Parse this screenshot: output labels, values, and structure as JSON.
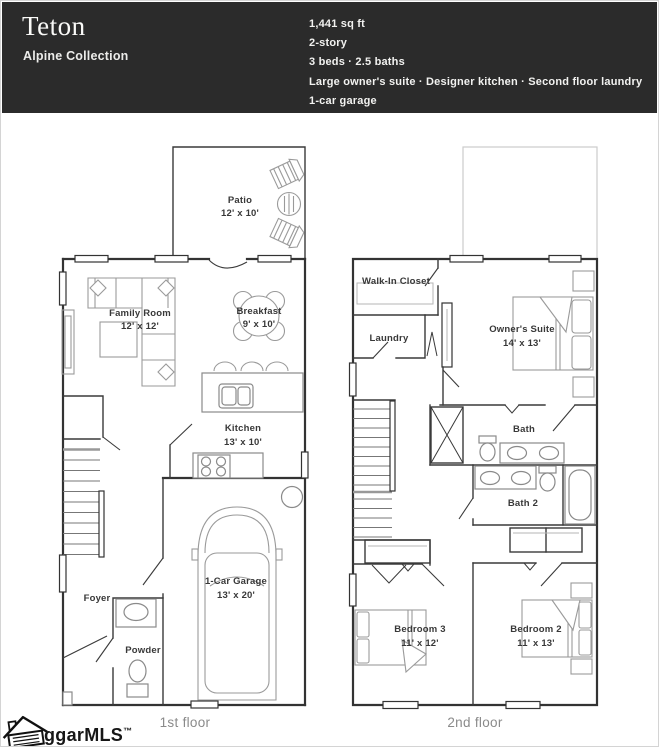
{
  "header": {
    "title": "Teton",
    "collection": "Alpine Collection",
    "specs": [
      "1,441 sq ft",
      "2-story",
      "3 beds · 2.5 baths",
      "Large owner's suite · Designer kitchen · Second floor laundry",
      "1-car garage"
    ]
  },
  "floor1": {
    "caption": "1st floor",
    "rooms": {
      "patio": {
        "name": "Patio",
        "dims": "12' x 10'"
      },
      "family_room": {
        "name": "Family Room",
        "dims": "12' x 12'"
      },
      "breakfast": {
        "name": "Breakfast",
        "dims": "9' x 10'"
      },
      "kitchen": {
        "name": "Kitchen",
        "dims": "13' x 10'"
      },
      "garage": {
        "name": "1-Car Garage",
        "dims": "13' x 20'"
      },
      "foyer": {
        "name": "Foyer"
      },
      "powder": {
        "name": "Powder"
      }
    }
  },
  "floor2": {
    "caption": "2nd floor",
    "rooms": {
      "walk_in_closet": {
        "name": "Walk-In Closet"
      },
      "laundry": {
        "name": "Laundry"
      },
      "owners_suite": {
        "name": "Owner's Suite",
        "dims": "14' x 13'"
      },
      "bath": {
        "name": "Bath"
      },
      "bath2": {
        "name": "Bath 2"
      },
      "bedroom3": {
        "name": "Bedroom 3",
        "dims": "11' x 12'"
      },
      "bedroom2": {
        "name": "Bedroom 2",
        "dims": "11' x 13'"
      }
    }
  },
  "watermark": {
    "text": "ggarMLS",
    "tm": "™"
  },
  "colors": {
    "header_bg": "#2b2b2b",
    "header_text": "#f2f2f0",
    "wall": "#333333",
    "furniture": "#9a9a9a",
    "ghost_outline": "#cccccc",
    "label": "#383838",
    "caption": "#8a8a8a"
  }
}
